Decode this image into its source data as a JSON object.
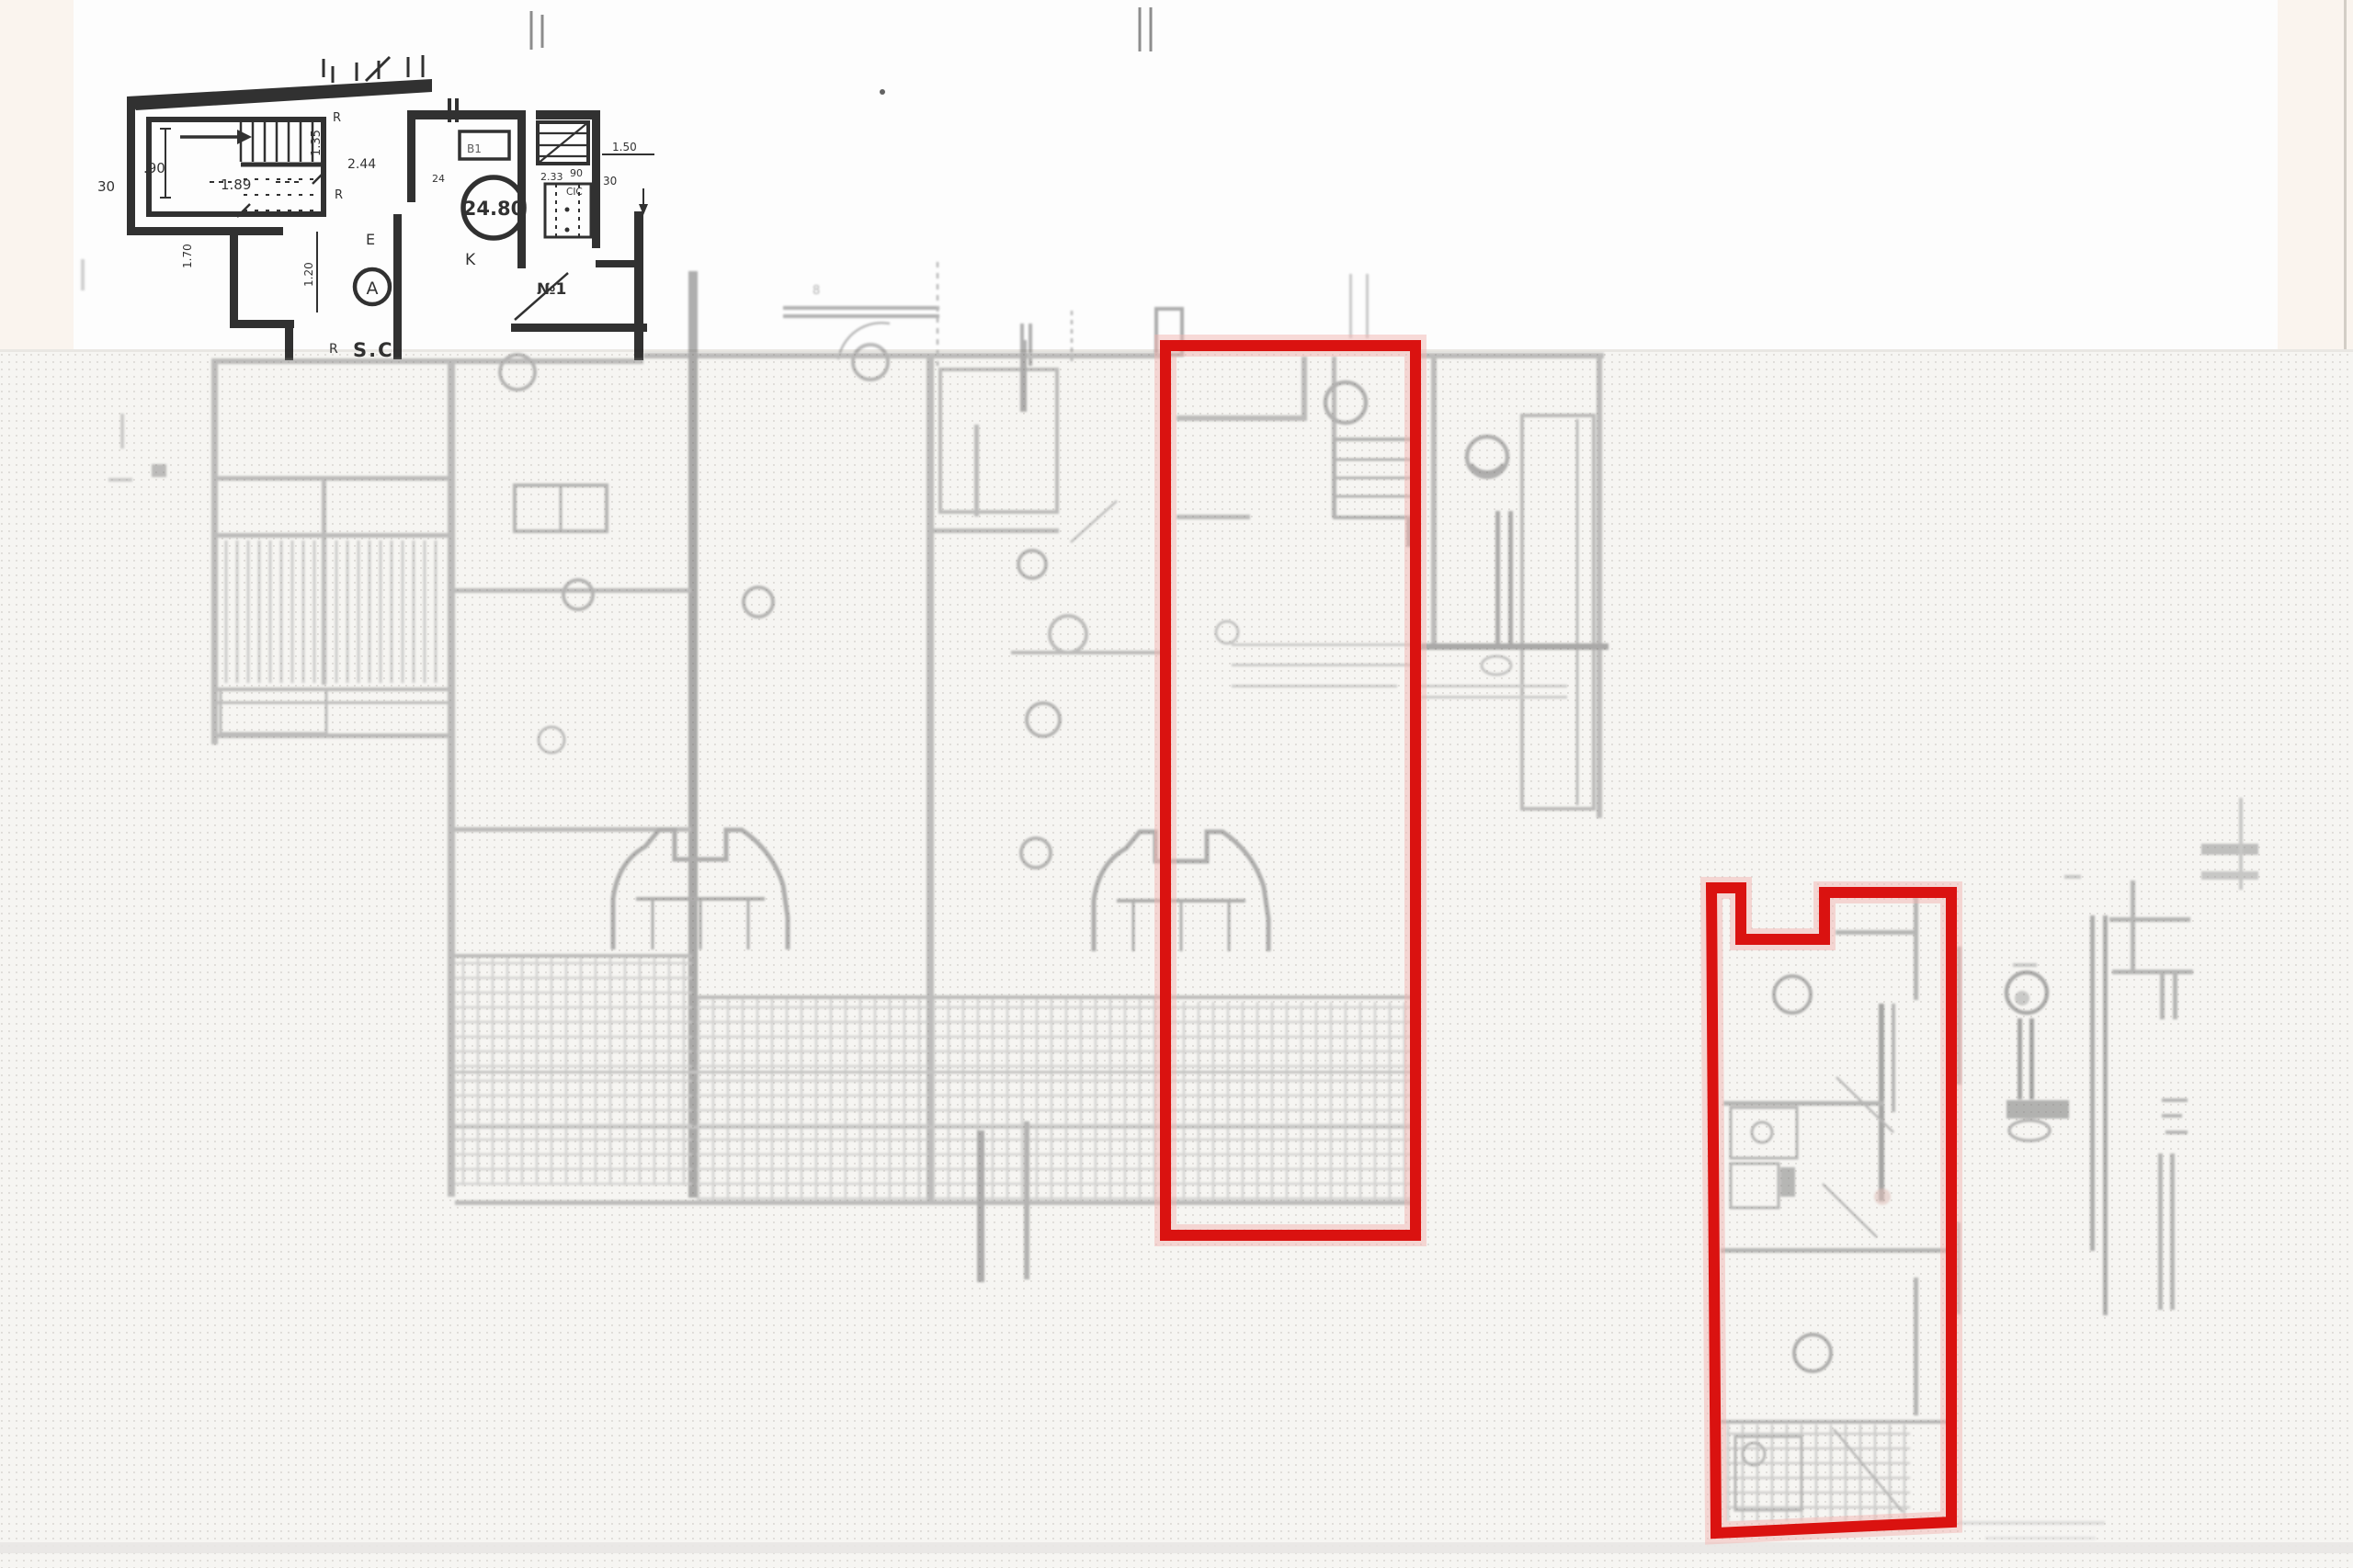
{
  "colors": {
    "highlight_red": "#da1210",
    "red_halo": "#f2b6b2",
    "ink_dark": "#1f1f1f",
    "ink_faded": "#787878",
    "paper_white": "#fdfdfd",
    "paper_tint_edge": "#faf4ee",
    "halftone_bg": "#f6f5f2",
    "halftone_dot": "#cfccc7"
  },
  "stair_fragment": {
    "dim_left_wall": "30",
    "dim_stair_width": ".90",
    "dim_stair_length": "1.89",
    "dim_landing": "1.35",
    "dim_hall": "2.44",
    "dim_hall_height": "1.20",
    "dim_left_lower": "1.70",
    "label_e": "E",
    "label_section": "A",
    "label_staircase": "S.C.",
    "r_mark_1": "R",
    "r_mark_2": "R",
    "r_mark_3": "R"
  },
  "unit_fragment": {
    "area_circle": "24.80",
    "label_kitchen": "K",
    "label_unit": "№1",
    "label_door": "B1",
    "dim_small": "24",
    "dim_width": "2.33",
    "dim_closet": "90",
    "label_closet": "CIC",
    "dim_right": "1.50",
    "dim_right_wall": "30"
  },
  "main_plan": {
    "dim_note": "8"
  }
}
